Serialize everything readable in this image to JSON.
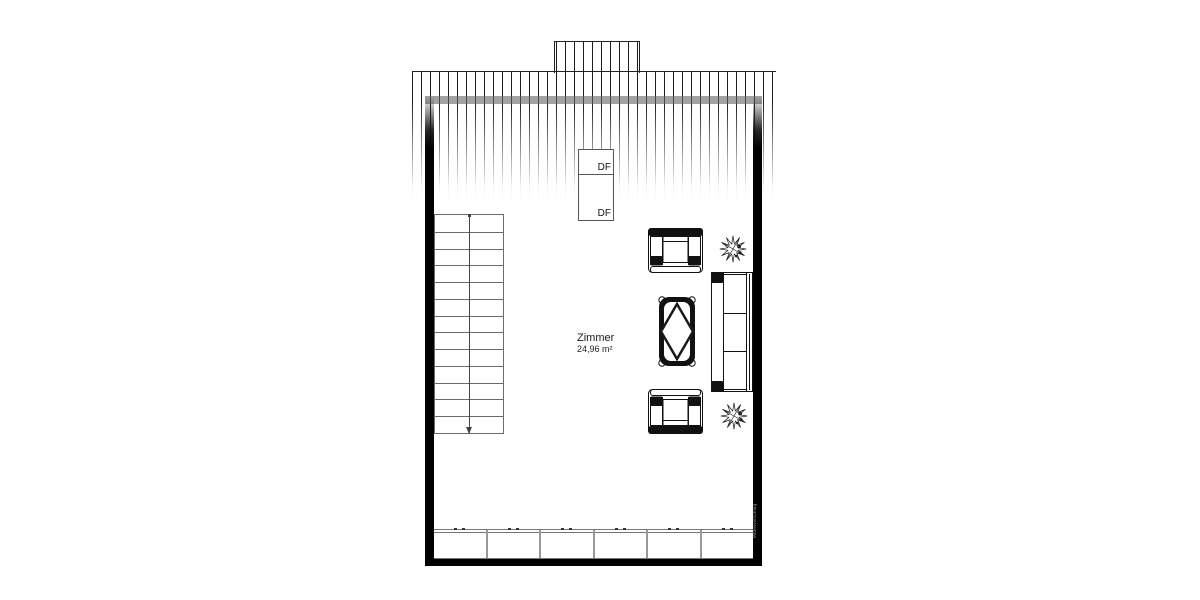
{
  "plan": {
    "room": {
      "name": "Zimmer",
      "area": "24,96 m²"
    },
    "skylights": [
      {
        "label": "DF"
      },
      {
        "label": "DF"
      }
    ],
    "stairs": {
      "tread_count": 13,
      "direction": "down"
    },
    "cabinets": {
      "section_count": 6
    },
    "watermark": "Möbelvorschlag",
    "furniture": [
      {
        "type": "armchair",
        "position": "top"
      },
      {
        "type": "coffee-table",
        "position": "center"
      },
      {
        "type": "armchair",
        "position": "bottom"
      },
      {
        "type": "sofa",
        "position": "right"
      },
      {
        "type": "plant",
        "position": "top-right"
      },
      {
        "type": "plant",
        "position": "bottom-right"
      }
    ],
    "colors": {
      "wall": "#000000",
      "hatch_line": "#1c1c1c",
      "stair_line": "#6b6b6b",
      "gray_band": "#787878"
    }
  }
}
